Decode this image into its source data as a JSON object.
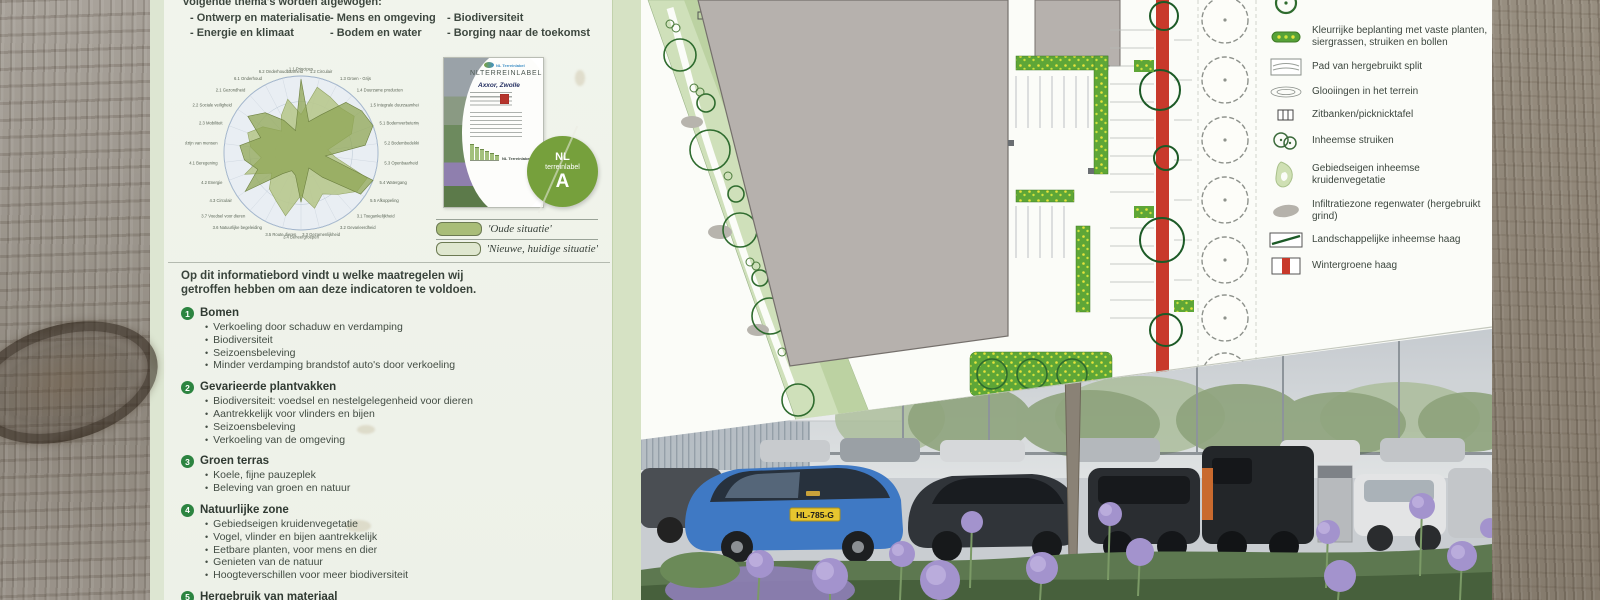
{
  "board": {
    "intro_line": "volgende thema's worden afgewogen:",
    "theme_columns": [
      [
        "- Ontwerp en materialisatie",
        "- Energie en klimaat"
      ],
      [
        "- Mens en omgeving",
        "- Bodem en water"
      ],
      [
        "- Biodiversiteit",
        "- Borging naar de toekomst"
      ]
    ]
  },
  "chart_data": {
    "type": "radar",
    "title": "NL Terreinlabel indicatoren",
    "rings": 3,
    "max": 100,
    "legend_position": "below-right",
    "axes": [
      "1.1 Principes",
      "1.2 Circulair",
      "1.3 Groen - Grijs",
      "1.4 Duurzame producten",
      "1.5 Integrale duurzaamheid",
      "5.1 Bodemverbetering",
      "5.2 Bodembedekking",
      "5.3 Openbaarheid",
      "5.4 Watergang",
      "5.5 Afkoppeling",
      "3.1 Toegankelijkheid",
      "3.2 Gevarieerdheid",
      "3.3 Gezamenlijkheid",
      "3.4 Beheergroepen",
      "3.5 Route dieren",
      "3.6 Natuurlijke begeleiding",
      "3.7 Voedsel voor dieren",
      "4.3 Circulair",
      "4.2 Energie",
      "4.1 Beregening",
      "2.4 Welzijn van mensen",
      "2.3 Mobiliteit",
      "2.2 Sociale veiligheid",
      "2.1 Gezondheid",
      "6.1 Onderhoud",
      "6.2 Onderhoudbaarheid"
    ],
    "series": [
      {
        "name": "'Oude situatie'",
        "color": "#b8c88e",
        "values": [
          50,
          88,
          82,
          78,
          84,
          70,
          35,
          45,
          92,
          88,
          72,
          60,
          74,
          55,
          84,
          70,
          62,
          46,
          78,
          52,
          66,
          74,
          60,
          38,
          55,
          72
        ]
      },
      {
        "name": "'Nieuwe, huidige situatie'",
        "color": "#8fa654",
        "values": [
          96,
          42,
          56,
          88,
          96,
          100,
          84,
          32,
          100,
          94,
          42,
          22,
          32,
          64,
          30,
          26,
          36,
          88,
          60,
          74,
          80,
          56,
          84,
          70,
          48,
          30
        ]
      }
    ]
  },
  "certificate": {
    "logo_text": "NL Terreinlabel",
    "title": "NLTERREINLABEL",
    "subtitle": "Axxor, Zwolle",
    "chart_caption": "NL Terreinlabel A",
    "badge": {
      "line1": "NL",
      "line2": "terreinlabel",
      "grade": "A"
    }
  },
  "series_legend": [
    {
      "style": "filled",
      "label": "'Oude situatie'"
    },
    {
      "style": "outline",
      "label": "'Nieuwe, huidige situatie'"
    }
  ],
  "measures": {
    "intro": "Op dit informatiebord vindt u welke maatregelen wij getroffen hebben om aan deze indicatoren te voldoen.",
    "sections": [
      {
        "num": "1",
        "title": "Bomen",
        "bullets": [
          "Verkoeling door schaduw en verdamping",
          "Biodiversiteit",
          "Seizoensbeleving",
          "Minder verdamping brandstof auto's door verkoeling"
        ]
      },
      {
        "num": "2",
        "title": "Gevarieerde plantvakken",
        "bullets": [
          "Biodiversiteit: voedsel en nestelgelegenheid voor dieren",
          "Aantrekkelijk voor vlinders en bijen",
          "Seizoensbeleving",
          "Verkoeling van de omgeving"
        ]
      },
      {
        "num": "3",
        "title": "Groen terras",
        "bullets": [
          "Koele, fijne pauzeplek",
          "Beleving van groen en natuur"
        ]
      },
      {
        "num": "4",
        "title": "Natuurlijke zone",
        "bullets": [
          "Gebiedseigen kruidenvegetatie",
          "Vogel, vlinder en bijen aantrekkelijk",
          "Eetbare planten, voor mens en dier",
          "Genieten van de natuur",
          "Hoogteverschillen voor meer biodiversiteit"
        ]
      },
      {
        "num": "5",
        "title": "Hergebruik van materiaal",
        "bullets": []
      }
    ]
  },
  "map_legend": [
    {
      "icon": "tree-circle",
      "label": ""
    },
    {
      "icon": "colorful-bed",
      "label": "Kleurrijke beplanting met vaste planten, siergrassen, struiken en bollen"
    },
    {
      "icon": "path-split",
      "label": "Pad van hergebruikt split"
    },
    {
      "icon": "contours",
      "label": "Glooiingen in het terrein"
    },
    {
      "icon": "bench",
      "label": "Zitbanken/picknicktafel"
    },
    {
      "icon": "shrubs",
      "label": "Inheemse struiken"
    },
    {
      "icon": "herb-blob",
      "label": "Gebiedseigen inheemse kruidenvegetatie"
    },
    {
      "icon": "gravel-blob",
      "label": "Infiltratiezone regenwater (hergebruikt grind)"
    },
    {
      "icon": "hedge-line",
      "label": "Landschappelijke inheemse haag"
    },
    {
      "icon": "red-hedge",
      "label": "Wintergroene haag"
    }
  ],
  "photo": {
    "license_plate": "HL-785-G"
  },
  "colors": {
    "board_bg": "#eff2ea",
    "accent_green": "#2c8440",
    "badge_green": "#76a03c",
    "hedge_red": "#c8392b"
  }
}
